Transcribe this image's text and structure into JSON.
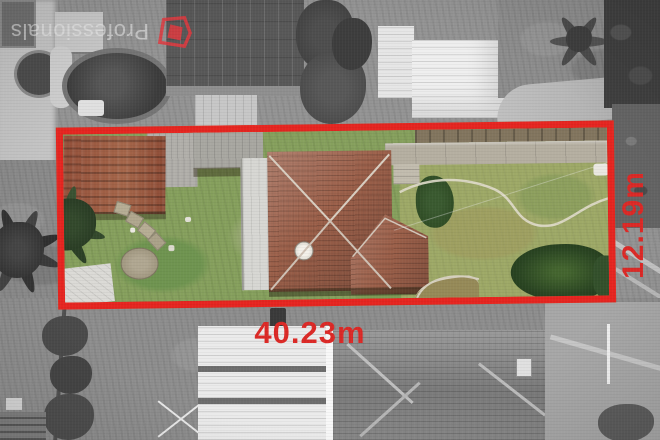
{
  "annotations": {
    "width_label": "40.23m",
    "depth_label": "12.19m"
  },
  "watermark": {
    "brand": "Professionals"
  },
  "colors": {
    "boundary_red": "#e62520",
    "label_red": "#dc2926",
    "logo_red": "#e23a40"
  }
}
